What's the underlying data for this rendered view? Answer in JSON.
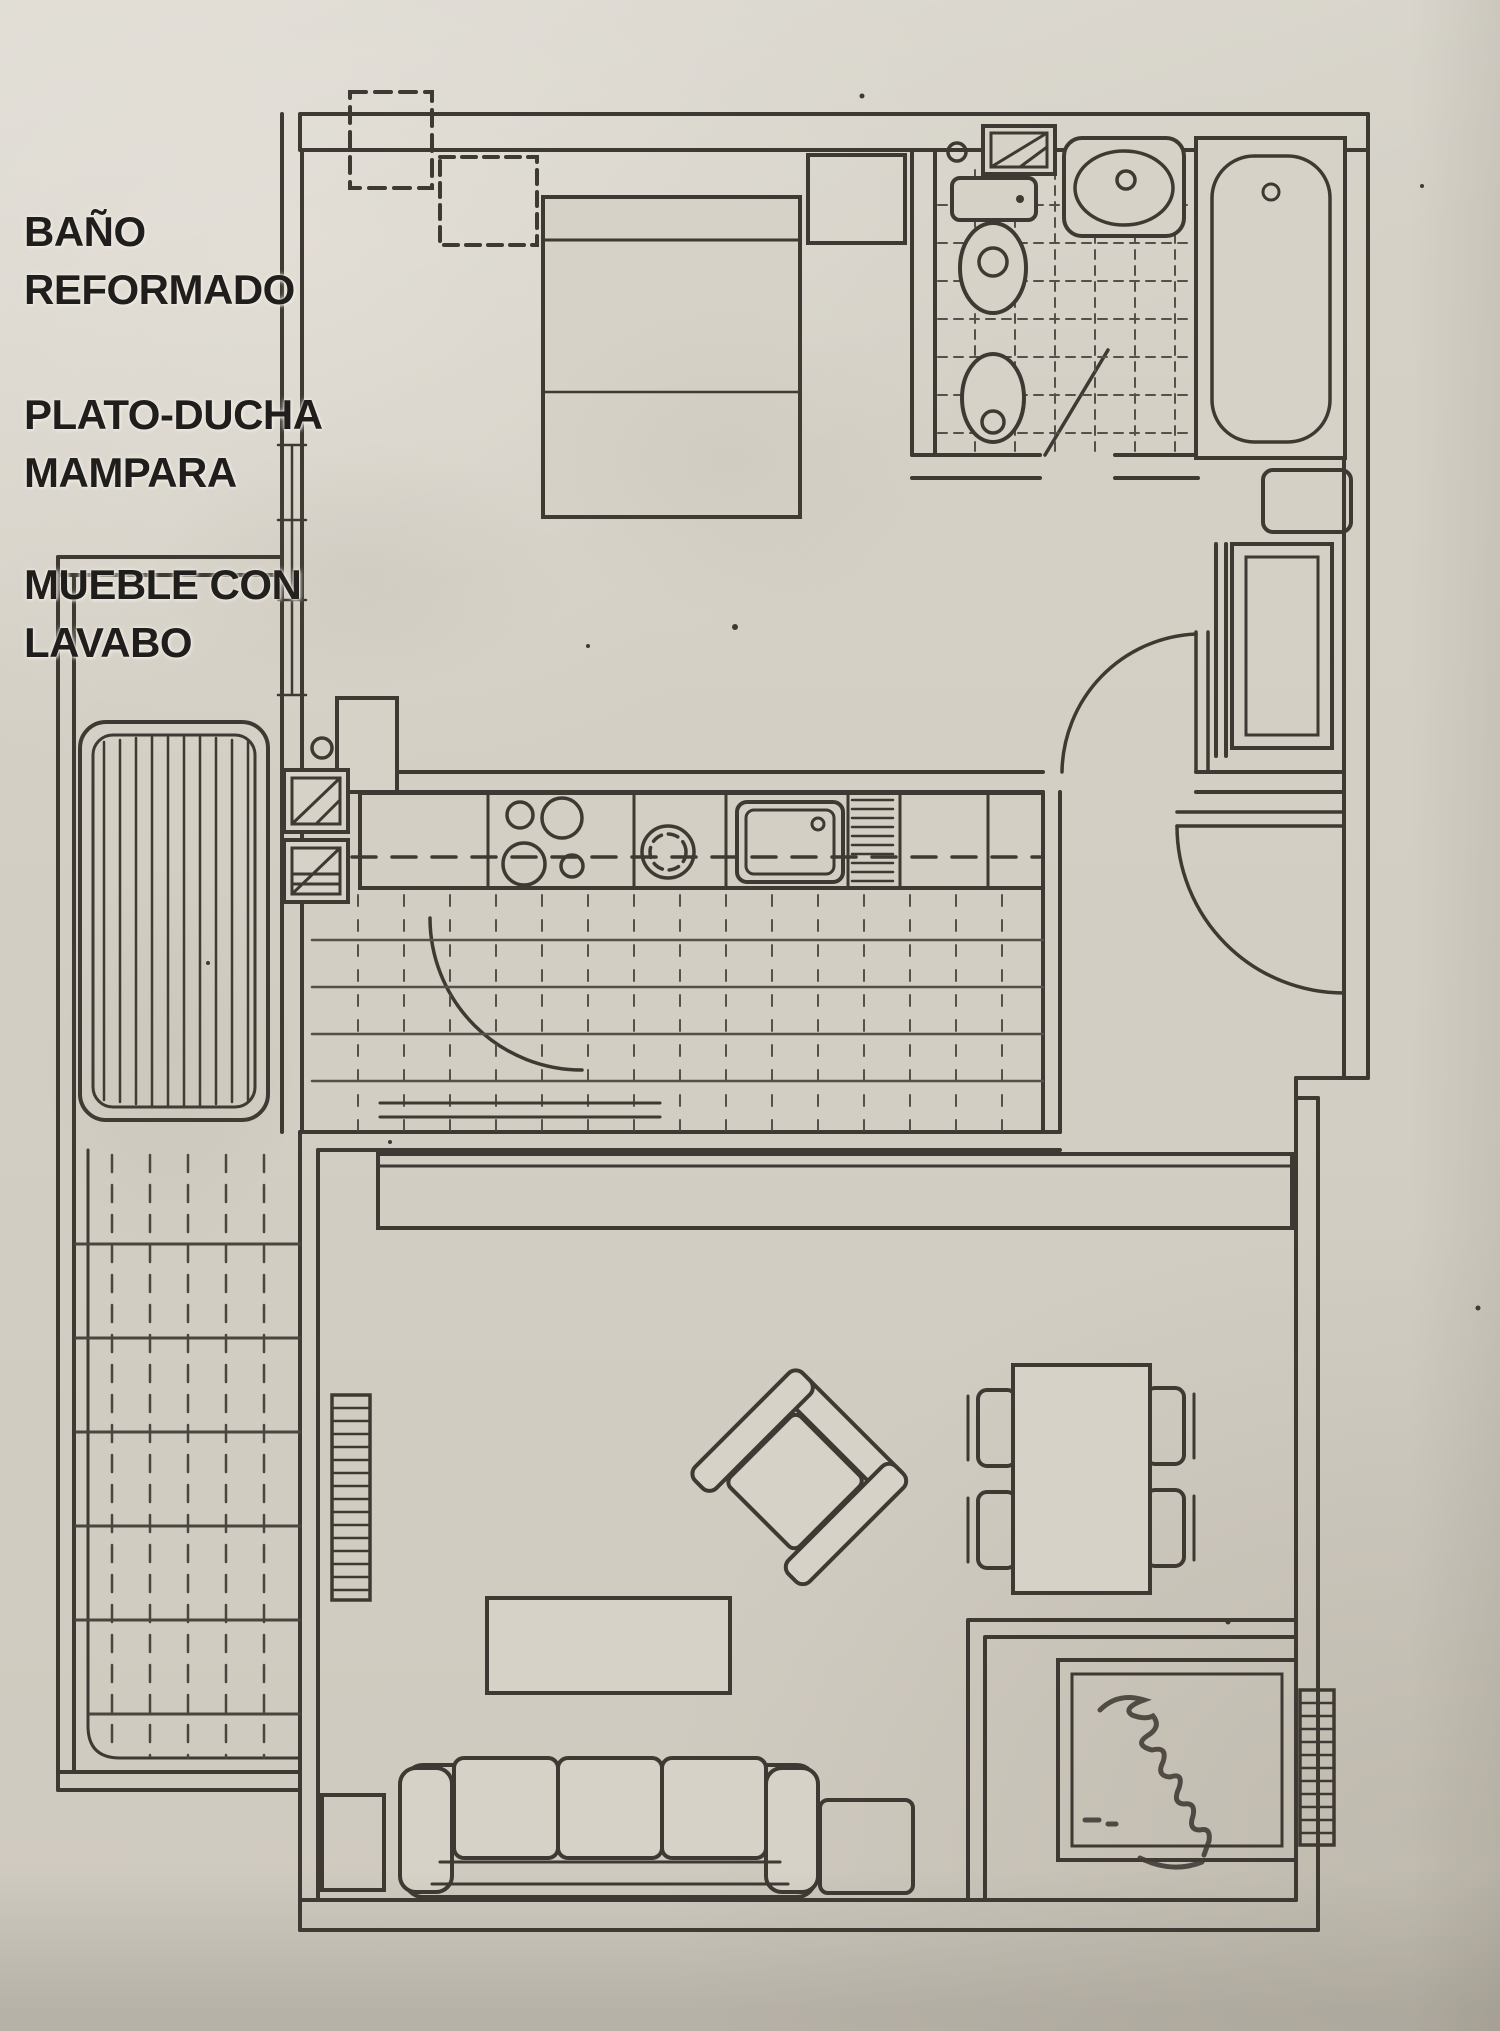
{
  "document": {
    "kind": "scanned apartment floor plan photograph",
    "palette": {
      "paper": "#d6d2c8",
      "paper_light": "#ded9d0",
      "paper_shadow": "#b9b4a9",
      "ink": "#3e3a33",
      "annotation_text": "#1f1e1c"
    }
  },
  "annotations": {
    "notes": [
      {
        "lines": [
          "BAÑO",
          "REFORMADO"
        ]
      },
      {
        "lines": [
          "PLATO-DUCHA",
          "MAMPARA"
        ]
      },
      {
        "lines": [
          "MUEBLE CON",
          "LAVABO"
        ]
      }
    ]
  },
  "plan": {
    "rooms": [
      "bedroom",
      "bathroom",
      "kitchen",
      "hall",
      "vestibule",
      "living-dining-room",
      "upper-balcony",
      "lower-terrace"
    ],
    "fixtures": [
      "double-bed",
      "nightstand",
      "pillar",
      "window",
      "toilet",
      "bidet",
      "washbasin",
      "bathtub",
      "bathroom-door",
      "cooktop-burners",
      "pot-ring",
      "kitchen-sink",
      "dish-rack",
      "washing-machine",
      "water-heater",
      "door-swing-arc",
      "entrance-door",
      "hall-closet",
      "sideboard",
      "sofa",
      "armchair",
      "coffee-table",
      "side-table",
      "dining-table",
      "dining-chair",
      "radiator",
      "cabinet",
      "balcony-slat-floor",
      "terrace-tile-floor",
      "kitchen-tile-floor",
      "bathroom-tile-floor",
      "handwritten-signature"
    ]
  }
}
